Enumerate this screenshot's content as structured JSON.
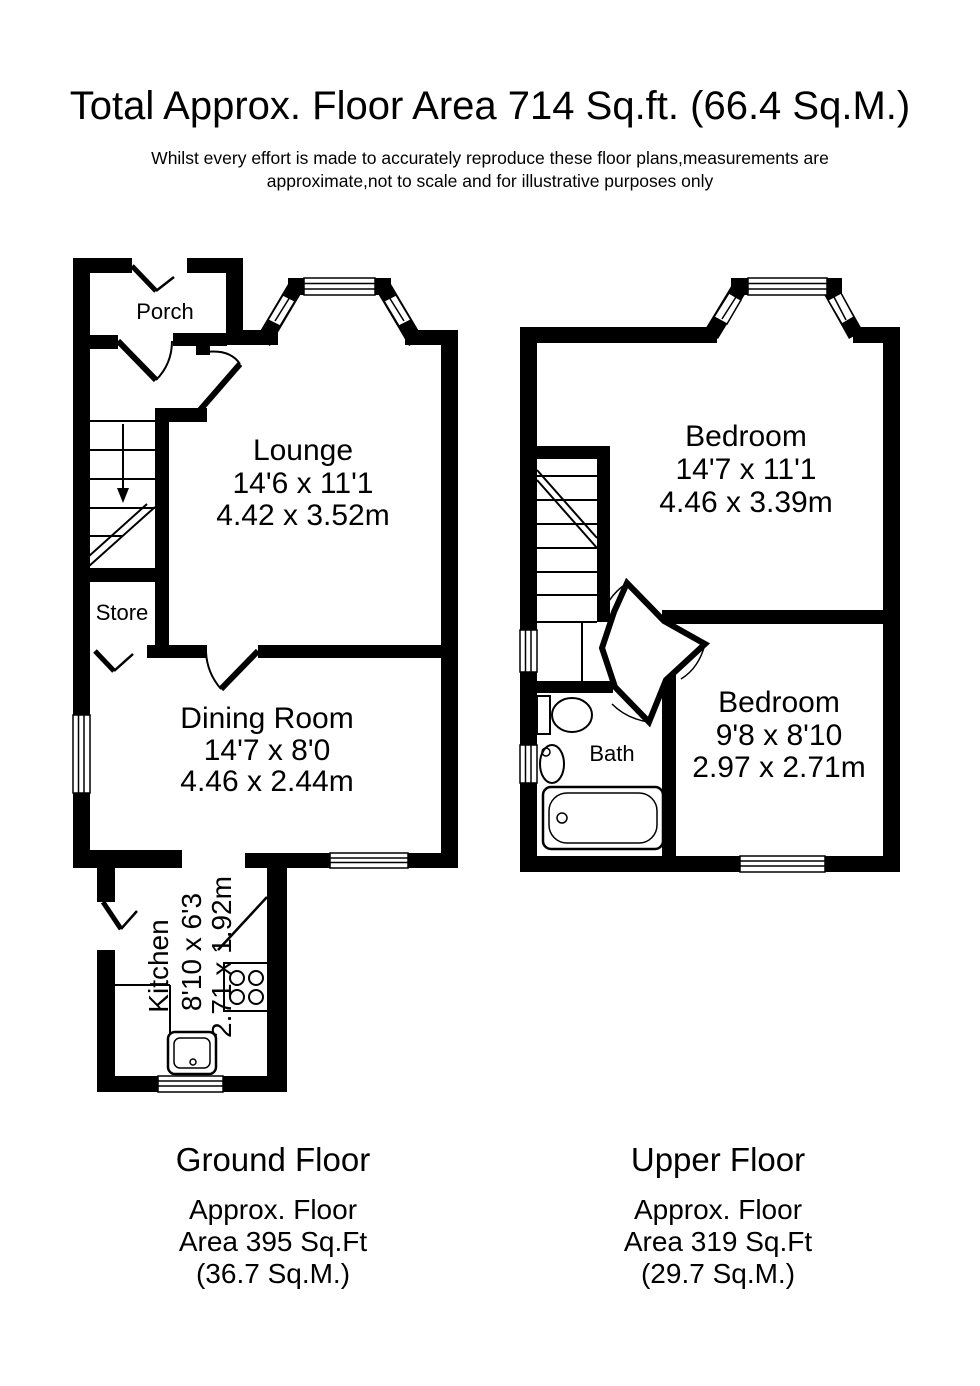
{
  "title": "Total Approx. Floor Area 714 Sq.ft. (66.4 Sq.M.)",
  "disclaimer": {
    "line1": "Whilst every effort is made to accurately reproduce these floor plans,measurements are",
    "line2": "approximate,not to scale and for illustrative purposes only"
  },
  "colors": {
    "wall": "#000000",
    "background": "#ffffff",
    "text": "#000000"
  },
  "ground_floor": {
    "label": "Ground Floor",
    "area_line1": "Approx. Floor",
    "area_line2": "Area 395 Sq.Ft",
    "area_line3": "(36.7 Sq.M.)",
    "rooms": {
      "porch": {
        "name": "Porch"
      },
      "lounge": {
        "name": "Lounge",
        "imperial": "14'6 x 11'1",
        "metric": "4.42 x 3.52m"
      },
      "store": {
        "name": "Store"
      },
      "dining": {
        "name": "Dining Room",
        "imperial": "14'7 x 8'0",
        "metric": "4.46 x 2.44m"
      },
      "kitchen": {
        "name": "Kitchen",
        "imperial": "8'10 x 6'3",
        "metric": "2.71 x 1.92m"
      }
    }
  },
  "upper_floor": {
    "label": "Upper Floor",
    "area_line1": "Approx. Floor",
    "area_line2": "Area 319 Sq.Ft",
    "area_line3": "(29.7 Sq.M.)",
    "rooms": {
      "bedroom1": {
        "name": "Bedroom",
        "imperial": "14'7 x 11'1",
        "metric": "4.46 x 3.39m"
      },
      "bedroom2": {
        "name": "Bedroom",
        "imperial": "9'8 x 8'10",
        "metric": "2.97 x 2.71m"
      },
      "bath": {
        "name": "Bath"
      }
    }
  }
}
